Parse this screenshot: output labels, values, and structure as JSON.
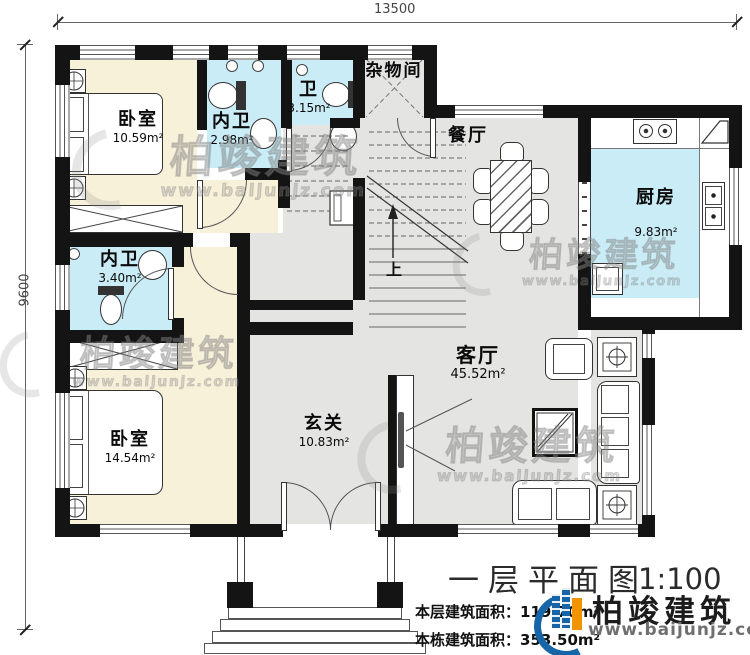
{
  "dimensions": {
    "width_label": "13500",
    "height_label": "9600"
  },
  "rooms": {
    "bedroom1": {
      "label": "卧室",
      "area": "10.59m²"
    },
    "ensuite1": {
      "label": "内卫",
      "area": "2.98m²"
    },
    "wc": {
      "label": "卫",
      "area": "3.15m²"
    },
    "storage": {
      "label": "杂物间"
    },
    "dining": {
      "label": "餐厅"
    },
    "kitchen": {
      "label": "厨房",
      "area": "9.83m²"
    },
    "ensuite2": {
      "label": "内卫",
      "area": "3.40m²"
    },
    "bedroom2": {
      "label": "卧室",
      "area": "14.54m²"
    },
    "foyer": {
      "label": "玄关",
      "area": "10.83m²"
    },
    "living": {
      "label": "客厅",
      "area": "45.52m²"
    }
  },
  "stairs": {
    "up_label": "上"
  },
  "title_block": {
    "title": "一层平面图",
    "scale": "1:100",
    "floor_area_label": "本层建筑面积：",
    "floor_area_value": "119.70m²",
    "total_area_label": "本栋建筑面积：",
    "total_area_value": "353.50m²"
  },
  "brand": {
    "name": "柏竣建筑",
    "website": "www.baijunjz.com"
  },
  "watermark": {
    "text": "柏竣建筑",
    "website": "www.baijunjz.com"
  }
}
